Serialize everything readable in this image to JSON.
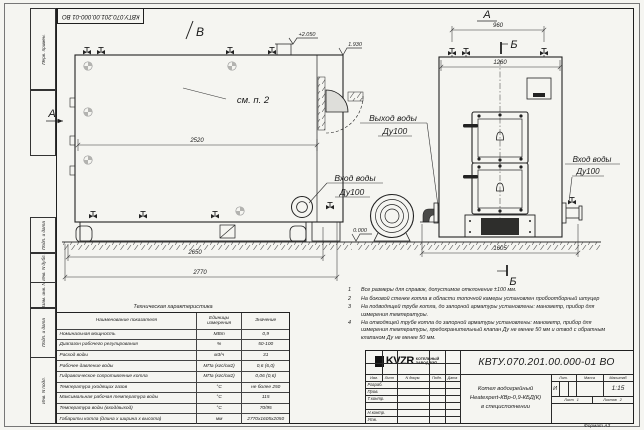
{
  "page": {
    "format_label": "Формат А3"
  },
  "frame": {
    "top_doc_number": "КВТУ.070.201.00.000-01 ВО",
    "side_labels": [
      "Перв. примен.",
      "",
      "Подп. и дата",
      "Инв. N дубл.",
      "Взам. инв. N",
      "Подп. и дата",
      "Инв. N подл."
    ]
  },
  "views": {
    "marker_v": "В",
    "marker_a_left": "А",
    "marker_a_top": "А",
    "marker_b_top": "Б",
    "marker_b_bottom": "Б",
    "see_note": "см. п. 2",
    "elev_top": "+2.050",
    "elev_duct": "1.930",
    "elev_zero": "0.000",
    "dim_2520": "2520",
    "dim_2650": "2650",
    "dim_2770": "2770",
    "dim_960": "960",
    "dim_1260": "1260",
    "dim_1605": "1605",
    "outlet_label_1": "Выход воды",
    "outlet_label_2": "Ду100",
    "inlet_left_label_1": "Вход воды",
    "inlet_left_label_2": "Ду100",
    "inlet_right_label_1": "Вход воды",
    "inlet_right_label_2": "Ду100"
  },
  "spec_table": {
    "title": "Техническая характеристика",
    "headers": [
      "Наименование показателя",
      "Единицы измерения",
      "Значение"
    ],
    "rows": [
      {
        "name": "Номинальная мощность",
        "unit": "МВт",
        "value": "0,9"
      },
      {
        "name": "Диапазон рабочего регулирования",
        "unit": "%",
        "value": "50-100"
      },
      {
        "name": "Расход воды",
        "unit": "м3/ч",
        "value": "31"
      },
      {
        "name": "Рабочее давление воды",
        "unit": "МПа (кгс/см2)",
        "value": "0,6 (6,0)"
      },
      {
        "name": "Гидравлическое сопротивление котла",
        "unit": "МПа (кгс/см2)",
        "value": "0,06 (0,6)"
      },
      {
        "name": "Температура уходящих газов",
        "unit": "°С",
        "value": "не более 250"
      },
      {
        "name": "Максимальная рабочая температура воды",
        "unit": "°С",
        "value": "115"
      },
      {
        "name": "Температура воды (вход/выход)",
        "unit": "°С",
        "value": "70/95"
      },
      {
        "name": "Габариты котла (длина х ширина х высота)",
        "unit": "мм",
        "value": "2770х1605х2050"
      }
    ]
  },
  "notes": [
    {
      "num": "1",
      "text": "Все размеры для справок, допустимое отклонение ±100 мм."
    },
    {
      "num": "2",
      "text": "На боковой стенке котла в области топочной камеры установлен пробоотборный штуцер"
    },
    {
      "num": "3",
      "text": "На подводящей трубе котла, до запорной арматуры установлены: манометр, прибор для измерения температуры."
    },
    {
      "num": "4",
      "text": "На отводящей трубе котла до запорной арматуры установлены: манометр, прибор для измерения температуры, предохранительный клапан Ду не менее 50 мм и отвод с обратным клапаном Ду не менее 50 мм."
    }
  ],
  "title_block": {
    "doc_number": "КВТУ.070.201.00.000-01 ВО",
    "name_line1": "Котел водогрейный",
    "name_line2": "Heatexpert-КВр-0,9-КБД(К)",
    "name_line3": "в специсполнении",
    "col_izm": "Изм.",
    "col_list": "Лист",
    "col_doc": "N докум.",
    "col_podp": "Подп.",
    "col_data": "Дата",
    "row_razrab": "Разраб.",
    "row_prov": "Пров.",
    "row_tkontr": "Т.контр.",
    "row_nkontr": "Н.контр.",
    "row_utv": "Утв.",
    "lit_header": "Лит.",
    "mass_header": "Масса",
    "scale_header": "Масштаб",
    "lit_value": "И",
    "scale_value": "1:15",
    "sheet_label": "Лист",
    "sheet_value": "1",
    "sheets_label": "Листов",
    "sheets_value": "2",
    "logo_text": "KVZR",
    "company_line1": "КОТЕЛЬНЫЙ",
    "company_line2": "ЗАВОД РЭП"
  }
}
